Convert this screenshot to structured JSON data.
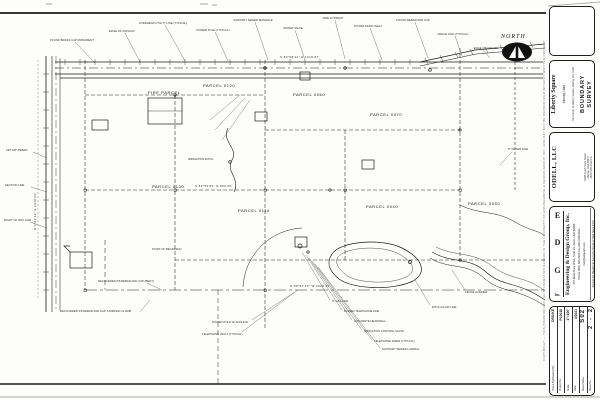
{
  "map": {
    "north_label": "NORTH",
    "parcels": [
      "PARCEL 0130",
      "FIRE PARCEL",
      "PARCEL 0120",
      "PARCEL 0060",
      "PARCEL 0070",
      "PARCEL 0040",
      "PARCEL 0110",
      "PARCEL 0050"
    ],
    "bearings": [
      "S 89°58'12\" E  1319.87'",
      "N 0°02'44\" E  2640.00'",
      "S 89°55'00\" E  660.00'",
      "N 89°57'30\" W  2639.45'"
    ],
    "callouts": [
      "FOUND BRASS CAP MONUMENT",
      "EDGE OF ASPHALT",
      "OVERHEAD UTILITY LINE (TYPICAL)",
      "POWER POLE (TYPICAL)",
      "SANITARY SEWER MANHOLE",
      "WATER VALVE",
      "FIRE HYDRANT",
      "STORM DRAIN INLET",
      "FOUND REBAR AND CAP",
      "FENCE LINE (TYPICAL)",
      "EDGE OF GRAVEL",
      "SET 5/8\" REBAR",
      "SECTION LINE",
      "RIGHT OF WAY LINE",
      "IRRIGATION DITCH",
      "POINT OF BEGINNING",
      "RECOVERED 5/8 REBAR AND CAP (BENT)",
      "RECOVERED 5/8 REBAR AND CAP STAMPED LS 4938",
      "4\" GAS LINE",
      "BURIED TELEPHONE LINE",
      "CONCRETE HEADWALL",
      "IRRIGATION CONTROL VALVE",
      "TELEPHONE RISER (TYPICAL)",
      "SANITARY SEWER LATERAL",
      "DITCH FLOW LINE",
      "FENCE CORNER",
      "POWER POLE W/ ANCHOR",
      "TELEPHONE VAULT (TYPICAL)",
      "8\" WATER LINE"
    ]
  },
  "title_block": {
    "project": {
      "name": "Liberty Square",
      "location": "Murray, Utah",
      "description": "SE Corner of Liberty Square, Murray City, Utah",
      "sheet_title_1": "BOUNDARY",
      "sheet_title_2": "SURVEY"
    },
    "client": {
      "name": "ODELL, LLC",
      "address1": "5248 South State Street",
      "address2": "Murray, Utah 84107",
      "phone": "(801) 555-0139  Ph."
    },
    "firm": {
      "logo": [
        "E",
        "D",
        "G",
        "Inc."
      ],
      "name": "Engineering & Design Group, Inc.",
      "address": "207 West Plaza Drive, Suite 10, Orem, Utah 84058",
      "phone": "Phone (801) 805-0010   Fax (801) 805-0011",
      "email": "mail@edgutah.com",
      "tagline": "Serving the Mapping & Surveying Needs of Utah Since 1979"
    },
    "sheet_info": {
      "rows": [
        {
          "label": "Drawn By/Checked By:",
          "value": "DRO/KE"
        },
        {
          "label": "Project No.:",
          "value": "PL0018"
        },
        {
          "label": "Scale:",
          "value": "1\"=100'"
        },
        {
          "label": "Date:",
          "value": "4/2021"
        },
        {
          "label": "Sheet Name:",
          "value": "S02"
        }
      ],
      "sheet_no_label": "Sheet No.:",
      "sheet_no_left": "2",
      "sheet_no_sep": "-",
      "sheet_no_right": "2"
    },
    "fine_print": "COPYRIGHT — THIS DRAWING AND THE INFORMATION HEREON IS THE PROPERTY OF ENGINEERING & DESIGN GROUP, INC. AND MAY NOT BE REPRODUCED WITHOUT WRITTEN CONSENT."
  }
}
